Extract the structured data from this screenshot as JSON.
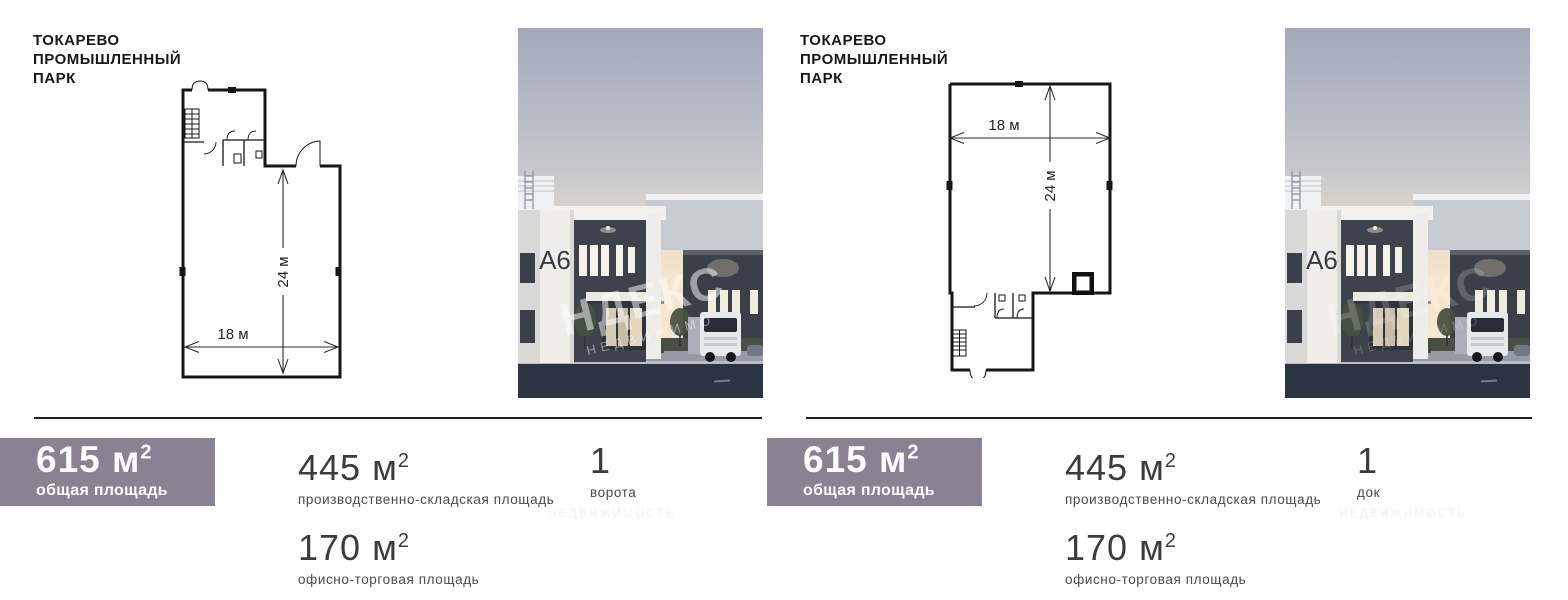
{
  "panels": [
    {
      "title": {
        "line1": "ТОКАРЕВО",
        "line2": "ПРОМЫШЛЕННЫЙ",
        "line3": "ПАРК"
      },
      "plan": {
        "width_label": "18 м",
        "height_label": "24 м"
      },
      "photo": {
        "building_label": "A6",
        "watermark_main": "НДЕКС",
        "watermark_sub": "НЕДВИЖИМО"
      },
      "stats": {
        "total_value": "615",
        "total_unit": "м",
        "total_sup": "2",
        "total_label": "общая площадь",
        "warehouse_value": "445",
        "warehouse_unit": "м",
        "warehouse_sup": "2",
        "warehouse_label": "производственно-складская площадь",
        "count_value": "1",
        "count_label": "ворота",
        "office_value": "170",
        "office_unit": "м",
        "office_sup": "2",
        "office_label": "офисно-торговая площадь"
      },
      "watermark_faint": "НЕДВИЖИМОСТЬ"
    },
    {
      "title": {
        "line1": "ТОКАРЕВО",
        "line2": "ПРОМЫШЛЕННЫЙ",
        "line3": "ПАРК"
      },
      "plan": {
        "width_label": "18 м",
        "height_label": "24 м"
      },
      "photo": {
        "building_label": "A6",
        "watermark_main": "НДЕКС",
        "watermark_sub": "НЕДВИЖИМО"
      },
      "stats": {
        "total_value": "615",
        "total_unit": "м",
        "total_sup": "2",
        "total_label": "общая площадь",
        "warehouse_value": "445",
        "warehouse_unit": "м",
        "warehouse_sup": "2",
        "warehouse_label": "производственно-складская площадь",
        "count_value": "1",
        "count_label": "док",
        "office_value": "170",
        "office_unit": "м",
        "office_sup": "2",
        "office_label": "офисно-торговая площадь"
      },
      "watermark_faint": "НЕДВИЖИМОСТЬ"
    }
  ],
  "colors": {
    "accent_box": "#8b8192",
    "divider": "#1f1f1f",
    "number": "#3c3c3c",
    "label": "#4a4a4a"
  }
}
